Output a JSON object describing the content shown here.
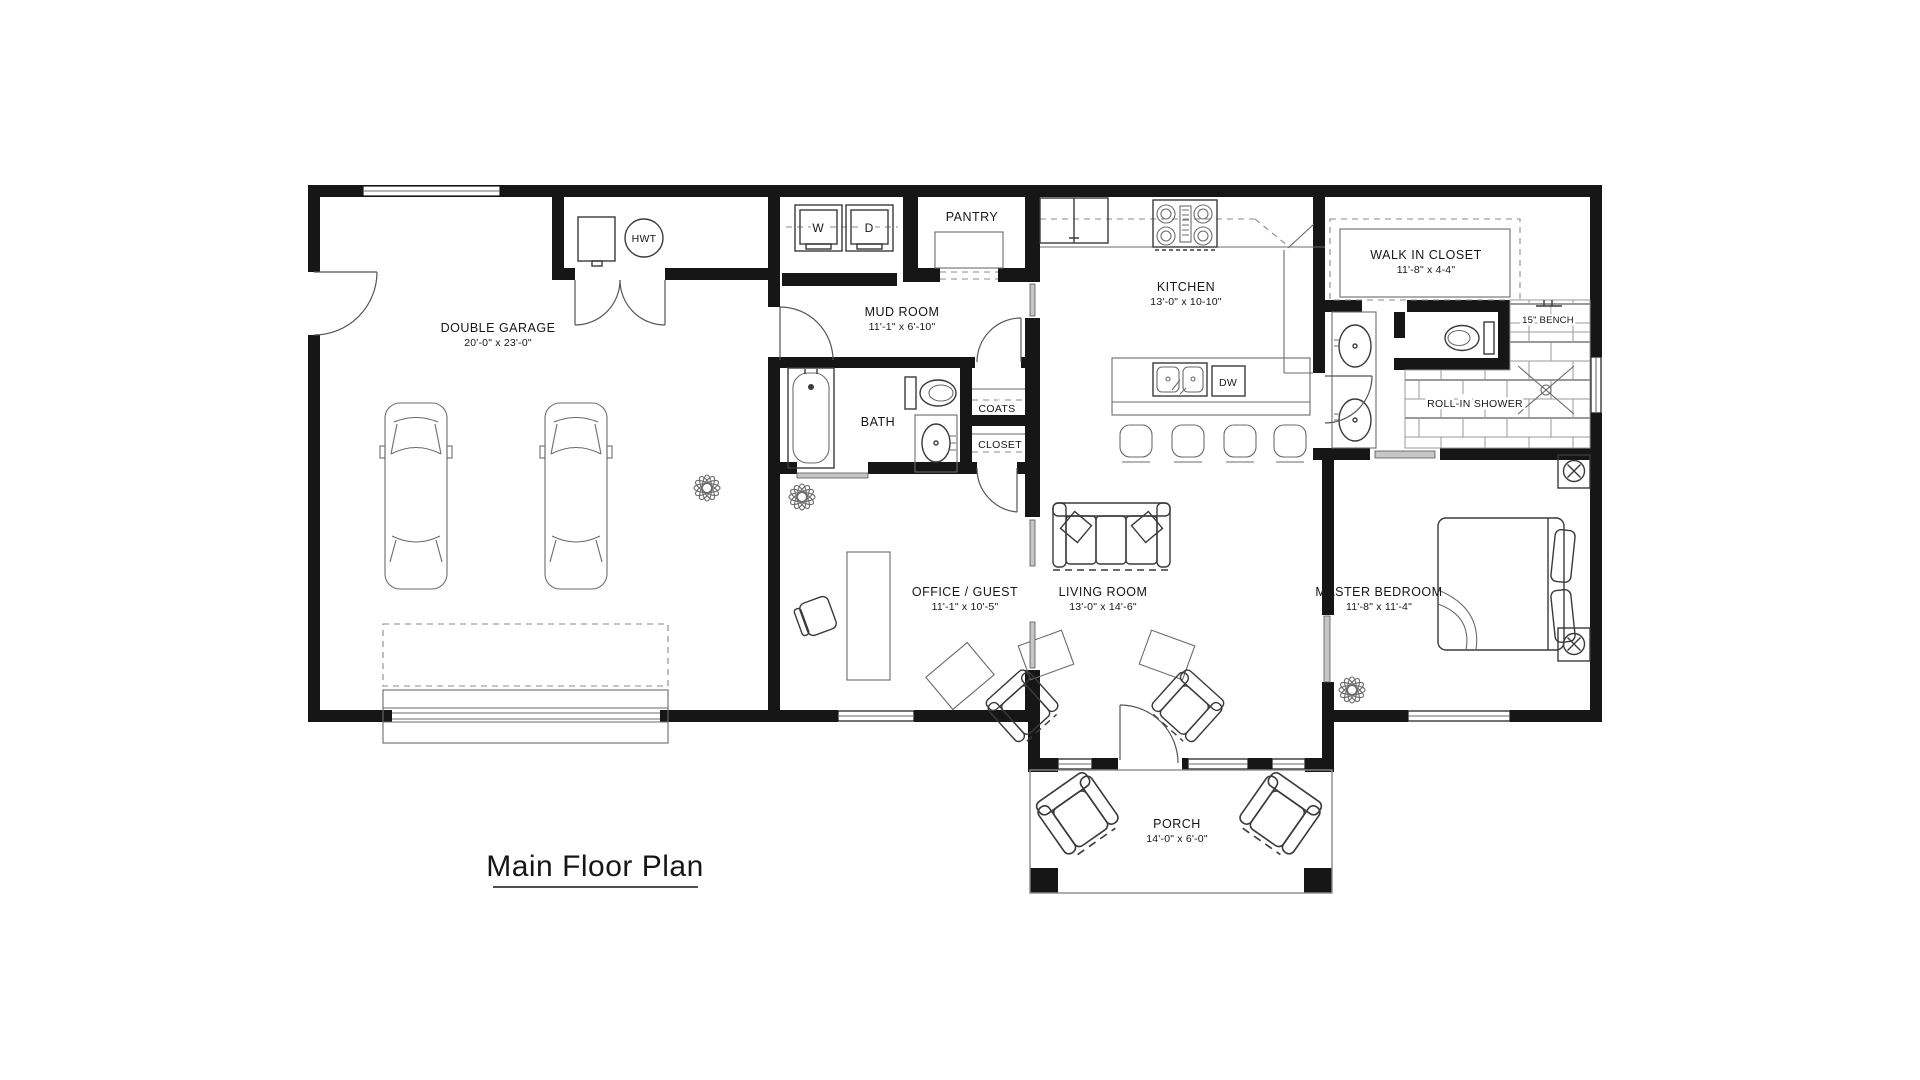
{
  "title": {
    "text": "Main Floor Plan"
  },
  "rooms": {
    "garage": {
      "name": "DOUBLE GARAGE",
      "dims": "20'-0\" x 23'-0\""
    },
    "mud_room": {
      "name": "MUD ROOM",
      "dims": "11'-1\" x 6'-10\""
    },
    "pantry": {
      "name": "PANTRY"
    },
    "kitchen": {
      "name": "KITCHEN",
      "dims": "13'-0\" x 10-10\""
    },
    "walk_in_closet": {
      "name": "WALK IN CLOSET",
      "dims": "11'-8\" x 4-4\""
    },
    "bath": {
      "name": "BATH"
    },
    "coats": {
      "name": "COATS"
    },
    "closet": {
      "name": "CLOSET"
    },
    "office": {
      "name": "OFFICE / GUEST",
      "dims": "11'-1\" x 10'-5\""
    },
    "living_room": {
      "name": "LIVING ROOM",
      "dims": "13'-0\" x 14'-6\""
    },
    "master_bedroom": {
      "name": "MASTER BEDROOM",
      "dims": "11'-8\" x 11'-4\""
    },
    "porch": {
      "name": "PORCH",
      "dims": "14'-0\" x 6'-0\""
    }
  },
  "fixtures": {
    "water_heater": "HWT",
    "washer": "W",
    "dryer": "D",
    "dishwasher": "DW",
    "bench": "15\" BENCH",
    "shower": "ROLL-IN SHOWER"
  }
}
